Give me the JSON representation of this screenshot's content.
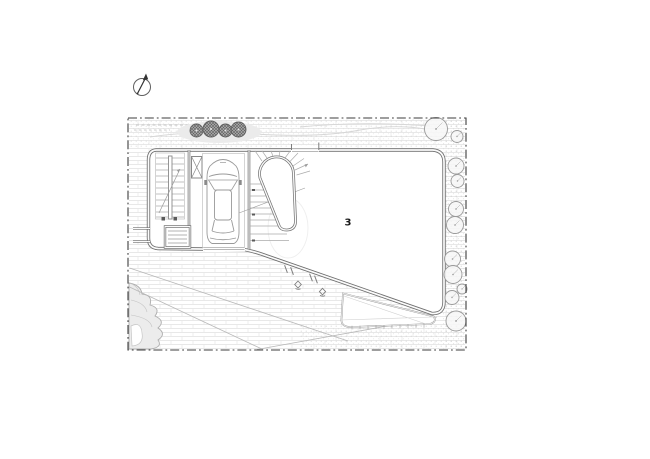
{
  "page": {
    "kind": "architectural-site-plan-drawing",
    "background": "#ffffff"
  },
  "plan": {
    "room_label": "3",
    "features": [
      "north-arrow",
      "property-boundary-dashdot",
      "paved-driveway",
      "straight-stair",
      "elevator-shaft",
      "parked-car-garage",
      "curved-stair",
      "main-room",
      "terrace-deck",
      "hedge-shrubs-top",
      "tree-row-right",
      "planting-bed-bottom-left"
    ],
    "counts": {
      "top_shrubs": 4,
      "right_trees": 11
    },
    "colors": {
      "paper": "#ffffff",
      "wall": "#6f6f6f",
      "thin_line": "#a8a8a8",
      "hatch": "#e1e1e1",
      "boundary": "#3c3c3c",
      "shrub_fill": "#8a8a8a",
      "label": "#1a1a1a"
    }
  }
}
